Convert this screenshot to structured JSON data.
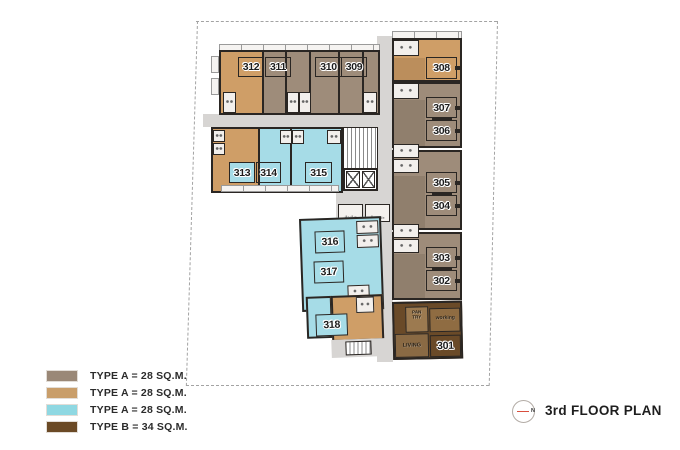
{
  "title": {
    "text": "3rd FLOOR PLAN",
    "compass_letter": "N"
  },
  "legend": {
    "items": [
      {
        "swatch_color": "#9A8877",
        "label": "TYPE A = 28 SQ.M."
      },
      {
        "swatch_color": "#C99E6A",
        "label": "TYPE A = 28 SQ.M."
      },
      {
        "swatch_color": "#8FD8E2",
        "label": "TYPE A = 28 SQ.M."
      },
      {
        "swatch_color": "#6B4A26",
        "label": "TYPE B = 34 SQ.M."
      }
    ]
  },
  "floor_plan": {
    "floor": "3rd",
    "units": {
      "301": "301",
      "302": "302",
      "303": "303",
      "304": "304",
      "305": "305",
      "306": "306",
      "307": "307",
      "308": "308",
      "309": "309",
      "310": "310",
      "311": "311",
      "312": "312",
      "313": "313",
      "314": "314",
      "315": "315",
      "316": "316",
      "317": "317",
      "318": "318"
    },
    "room_labels": {
      "pantry_line1": "PAN",
      "pantry_line2": "TRY",
      "working": "working",
      "living": "LIVING",
      "utility_left": "ห้องไฟ",
      "utility_right": "ห้องขยะ"
    },
    "unit_type_colors": {
      "type_a_taupe": "#9E8C7A",
      "type_a_tan": "#CF9E67",
      "type_a_cyan": "#A6DCE7",
      "type_b_brown": "#6A4A28"
    }
  }
}
